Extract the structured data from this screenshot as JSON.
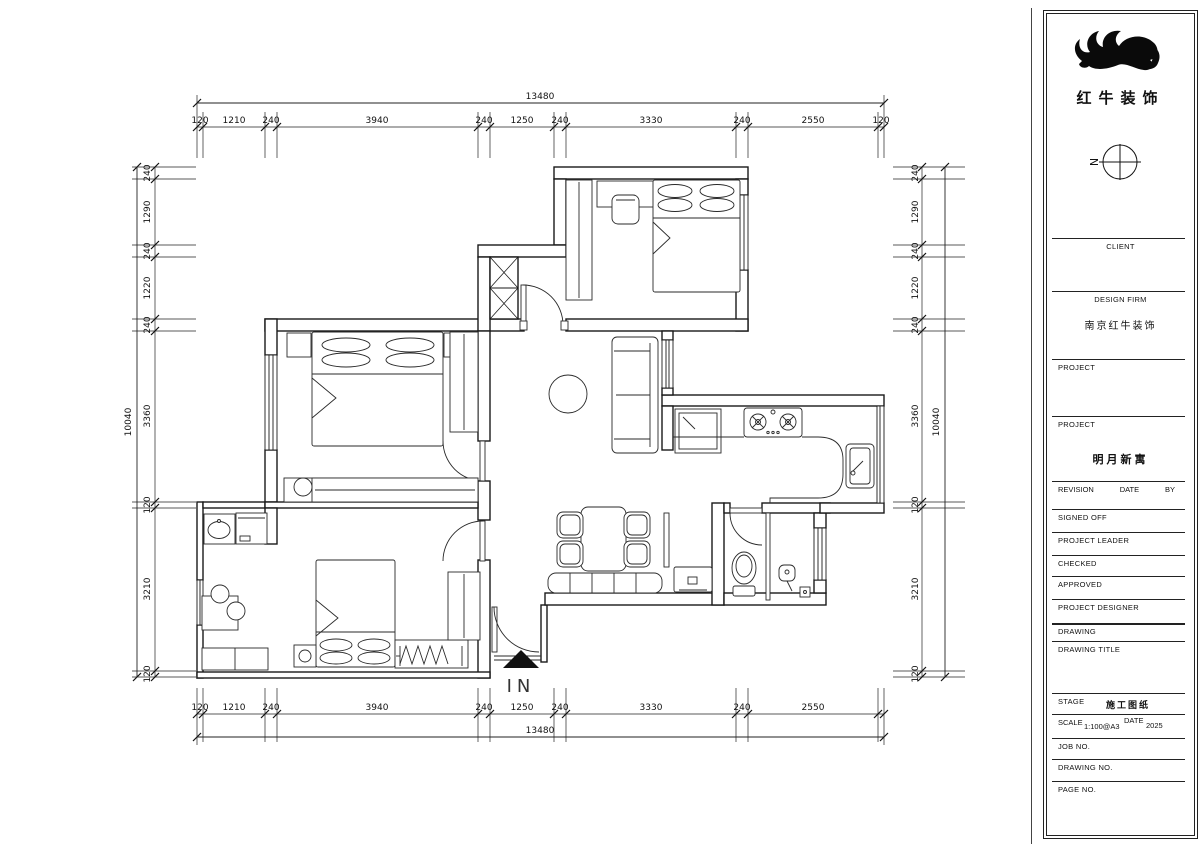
{
  "plan": {
    "entry_label": "IN"
  },
  "dims": {
    "top": {
      "total": "13480",
      "segments": [
        "120",
        "1210",
        "240",
        "3940",
        "240",
        "1250",
        "240",
        "3330",
        "240",
        "2550",
        "120"
      ]
    },
    "bottom": {
      "total": "13480",
      "segments": [
        "120",
        "1210",
        "240",
        "3940",
        "240",
        "1250",
        "240",
        "3330",
        "240",
        "2550"
      ]
    },
    "left": {
      "total": "10040",
      "segments": [
        "240",
        "1290",
        "240",
        "1220",
        "240",
        "3360",
        "120",
        "3210",
        "120"
      ]
    },
    "right": {
      "total": "10040",
      "segments": [
        "240",
        "1290",
        "240",
        "1220",
        "240",
        "3360",
        "120",
        "3210",
        "120"
      ]
    }
  },
  "titleblock": {
    "logo_text": "红牛装饰",
    "north_label": "N",
    "client_label": "CLIENT",
    "design_firm_label": "DESIGN FIRM",
    "design_firm_value": "南京红牛装饰",
    "project_label1": "PROJECT",
    "project_label2": "PROJECT",
    "project_value": "明月新寓",
    "revision_label": "REVISION",
    "date_label": "DATE",
    "by_label": "BY",
    "signed_off_label": "SIGNED OFF",
    "project_leader_label": "PROJECT LEADER",
    "checked_label": "CHECKED",
    "approved_label": "APPROVED",
    "project_designer_label": "PROJECT DESIGNER",
    "drawing_label": "DRAWING",
    "drawing_title_label": "DRAWING TITLE",
    "stage_label": "STAGE",
    "stage_value": "施工图纸",
    "scale_label": "SCALE",
    "scale_value": "1:100@A3",
    "date_label2": "DATE",
    "date_value": "2025",
    "job_no_label": "JOB NO.",
    "drawing_no_label": "DRAWING NO.",
    "page_no_label": "PAGE NO."
  }
}
